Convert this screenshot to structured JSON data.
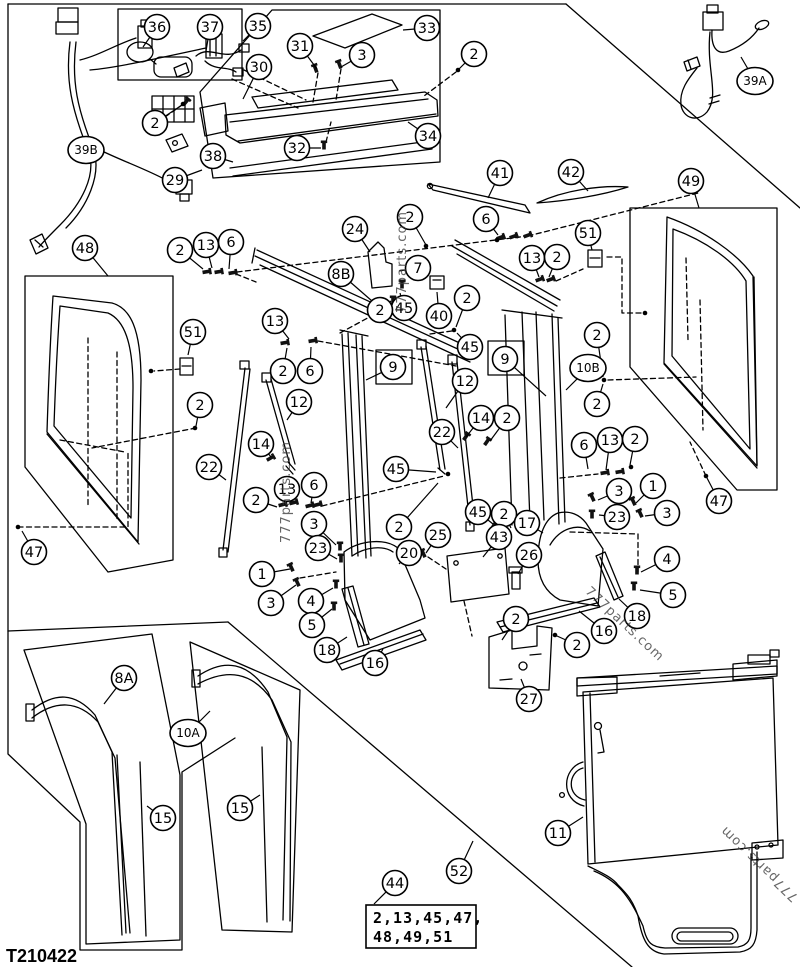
{
  "page": {
    "part_code": "T210422",
    "background_color": "#ffffff",
    "line_color": "#000000",
    "watermark_text": "777parts.com"
  },
  "note_box": {
    "callout": "44",
    "lines": [
      "2,13,45,47,",
      "48,49,51"
    ]
  },
  "watermarks": [
    {
      "text": "777parts.com",
      "x": 406,
      "y": 262,
      "rot": -90,
      "size": 13
    },
    {
      "text": "777parts.com",
      "x": 290,
      "y": 492,
      "rot": -90,
      "size": 13
    },
    {
      "text": "777parts.com",
      "x": 622,
      "y": 627,
      "rot": 43,
      "size": 13
    },
    {
      "text": "777parts.com",
      "x": 762,
      "y": 861,
      "rot": -136,
      "size": 13
    }
  ],
  "callouts": [
    [
      "36",
      157,
      27,
      143,
      47
    ],
    [
      "37",
      210,
      27,
      206,
      51
    ],
    [
      "35",
      258,
      26,
      243,
      41
    ],
    [
      "30",
      259,
      67,
      243,
      99
    ],
    [
      "31",
      300,
      46,
      317,
      69
    ],
    [
      "3",
      362,
      55,
      341,
      67
    ],
    [
      "33",
      427,
      28,
      403,
      30
    ],
    [
      "2",
      474,
      54,
      458,
      70
    ],
    [
      "2",
      155,
      123,
      182,
      105
    ],
    [
      "29",
      175,
      180,
      202,
      170
    ],
    [
      "38",
      213,
      156,
      233,
      162
    ],
    [
      "32",
      297,
      148,
      321,
      148
    ],
    [
      "34",
      428,
      136,
      408,
      122
    ],
    [
      "39B",
      86,
      150,
      73,
      143
    ],
    [
      "39A",
      755,
      81,
      741,
      57
    ],
    [
      "41",
      500,
      173,
      488,
      198
    ],
    [
      "42",
      571,
      172,
      588,
      191
    ],
    [
      "49",
      691,
      181,
      699,
      208
    ],
    [
      "51",
      588,
      233,
      592,
      250
    ],
    [
      "13",
      532,
      258,
      539,
      277
    ],
    [
      "2",
      557,
      257,
      549,
      277
    ],
    [
      "6",
      486,
      219,
      498,
      235
    ],
    [
      "47",
      719,
      501,
      707,
      478
    ],
    [
      "2",
      597,
      335,
      603,
      377
    ],
    [
      "10B",
      588,
      368,
      566,
      390
    ],
    [
      "2",
      597,
      404,
      603,
      384
    ],
    [
      "48",
      85,
      248,
      108,
      276
    ],
    [
      "2",
      180,
      250,
      203,
      269
    ],
    [
      "13",
      206,
      245,
      212,
      268
    ],
    [
      "6",
      231,
      242,
      229,
      269
    ],
    [
      "51",
      193,
      332,
      188,
      355
    ],
    [
      "2",
      200,
      405,
      196,
      426
    ],
    [
      "47",
      34,
      552,
      22,
      531
    ],
    [
      "22",
      209,
      467,
      226,
      480
    ],
    [
      "24",
      355,
      229,
      370,
      252
    ],
    [
      "2",
      410,
      217,
      426,
      245
    ],
    [
      "8B",
      341,
      274,
      372,
      301
    ],
    [
      "7",
      418,
      268,
      399,
      271
    ],
    [
      "40",
      439,
      316,
      437,
      292
    ],
    [
      "45",
      404,
      308,
      400,
      293
    ],
    [
      "2",
      380,
      310,
      391,
      301
    ],
    [
      "2",
      467,
      298,
      456,
      327
    ],
    [
      "45",
      470,
      347,
      457,
      333
    ],
    [
      "13",
      275,
      321,
      289,
      339
    ],
    [
      "2",
      283,
      371,
      287,
      348
    ],
    [
      "6",
      310,
      371,
      311,
      347
    ],
    [
      "9",
      393,
      367,
      366,
      380
    ],
    [
      "9",
      505,
      359,
      546,
      396
    ],
    [
      "12",
      299,
      402,
      287,
      420
    ],
    [
      "14",
      261,
      444,
      271,
      457
    ],
    [
      "2",
      256,
      500,
      277,
      507
    ],
    [
      "13",
      287,
      489,
      289,
      502
    ],
    [
      "6",
      314,
      485,
      311,
      503
    ],
    [
      "3",
      314,
      524,
      336,
      545
    ],
    [
      "23",
      318,
      548,
      337,
      559
    ],
    [
      "12",
      465,
      381,
      446,
      408
    ],
    [
      "14",
      481,
      418,
      466,
      437
    ],
    [
      "2",
      507,
      418,
      490,
      441
    ],
    [
      "22",
      442,
      432,
      458,
      448
    ],
    [
      "45",
      396,
      469,
      436,
      472
    ],
    [
      "2",
      399,
      527,
      438,
      483
    ],
    [
      "45",
      478,
      512,
      493,
      524
    ],
    [
      "2",
      504,
      514,
      511,
      528
    ],
    [
      "6",
      584,
      445,
      588,
      469
    ],
    [
      "13",
      610,
      440,
      606,
      470
    ],
    [
      "2",
      635,
      439,
      630,
      465
    ],
    [
      "3",
      619,
      491,
      598,
      500
    ],
    [
      "1",
      653,
      486,
      636,
      503
    ],
    [
      "23",
      617,
      517,
      599,
      515
    ],
    [
      "3",
      667,
      513,
      645,
      516
    ],
    [
      "4",
      667,
      559,
      641,
      572
    ],
    [
      "5",
      673,
      595,
      640,
      590
    ],
    [
      "20",
      409,
      553,
      399,
      564
    ],
    [
      "1",
      262,
      574,
      290,
      569
    ],
    [
      "3",
      271,
      603,
      296,
      585
    ],
    [
      "4",
      311,
      601,
      333,
      588
    ],
    [
      "5",
      312,
      625,
      332,
      609
    ],
    [
      "18",
      327,
      650,
      347,
      637
    ],
    [
      "16",
      375,
      663,
      383,
      649
    ],
    [
      "17",
      527,
      523,
      543,
      533
    ],
    [
      "25",
      438,
      535,
      426,
      553
    ],
    [
      "43",
      499,
      537,
      483,
      557
    ],
    [
      "26",
      529,
      555,
      518,
      574
    ],
    [
      "18",
      637,
      616,
      619,
      599
    ],
    [
      "16",
      604,
      631,
      579,
      611
    ],
    [
      "2",
      516,
      619,
      502,
      640
    ],
    [
      "2",
      577,
      645,
      557,
      636
    ],
    [
      "27",
      529,
      699,
      521,
      679
    ],
    [
      "11",
      558,
      833,
      583,
      817
    ],
    [
      "8A",
      124,
      678,
      104,
      704
    ],
    [
      "10A",
      188,
      733,
      210,
      711
    ],
    [
      "15",
      163,
      818,
      147,
      806
    ],
    [
      "15",
      240,
      808,
      260,
      795
    ],
    [
      "44",
      395,
      883,
      374,
      904
    ],
    [
      "52",
      459,
      871,
      473,
      841
    ]
  ]
}
